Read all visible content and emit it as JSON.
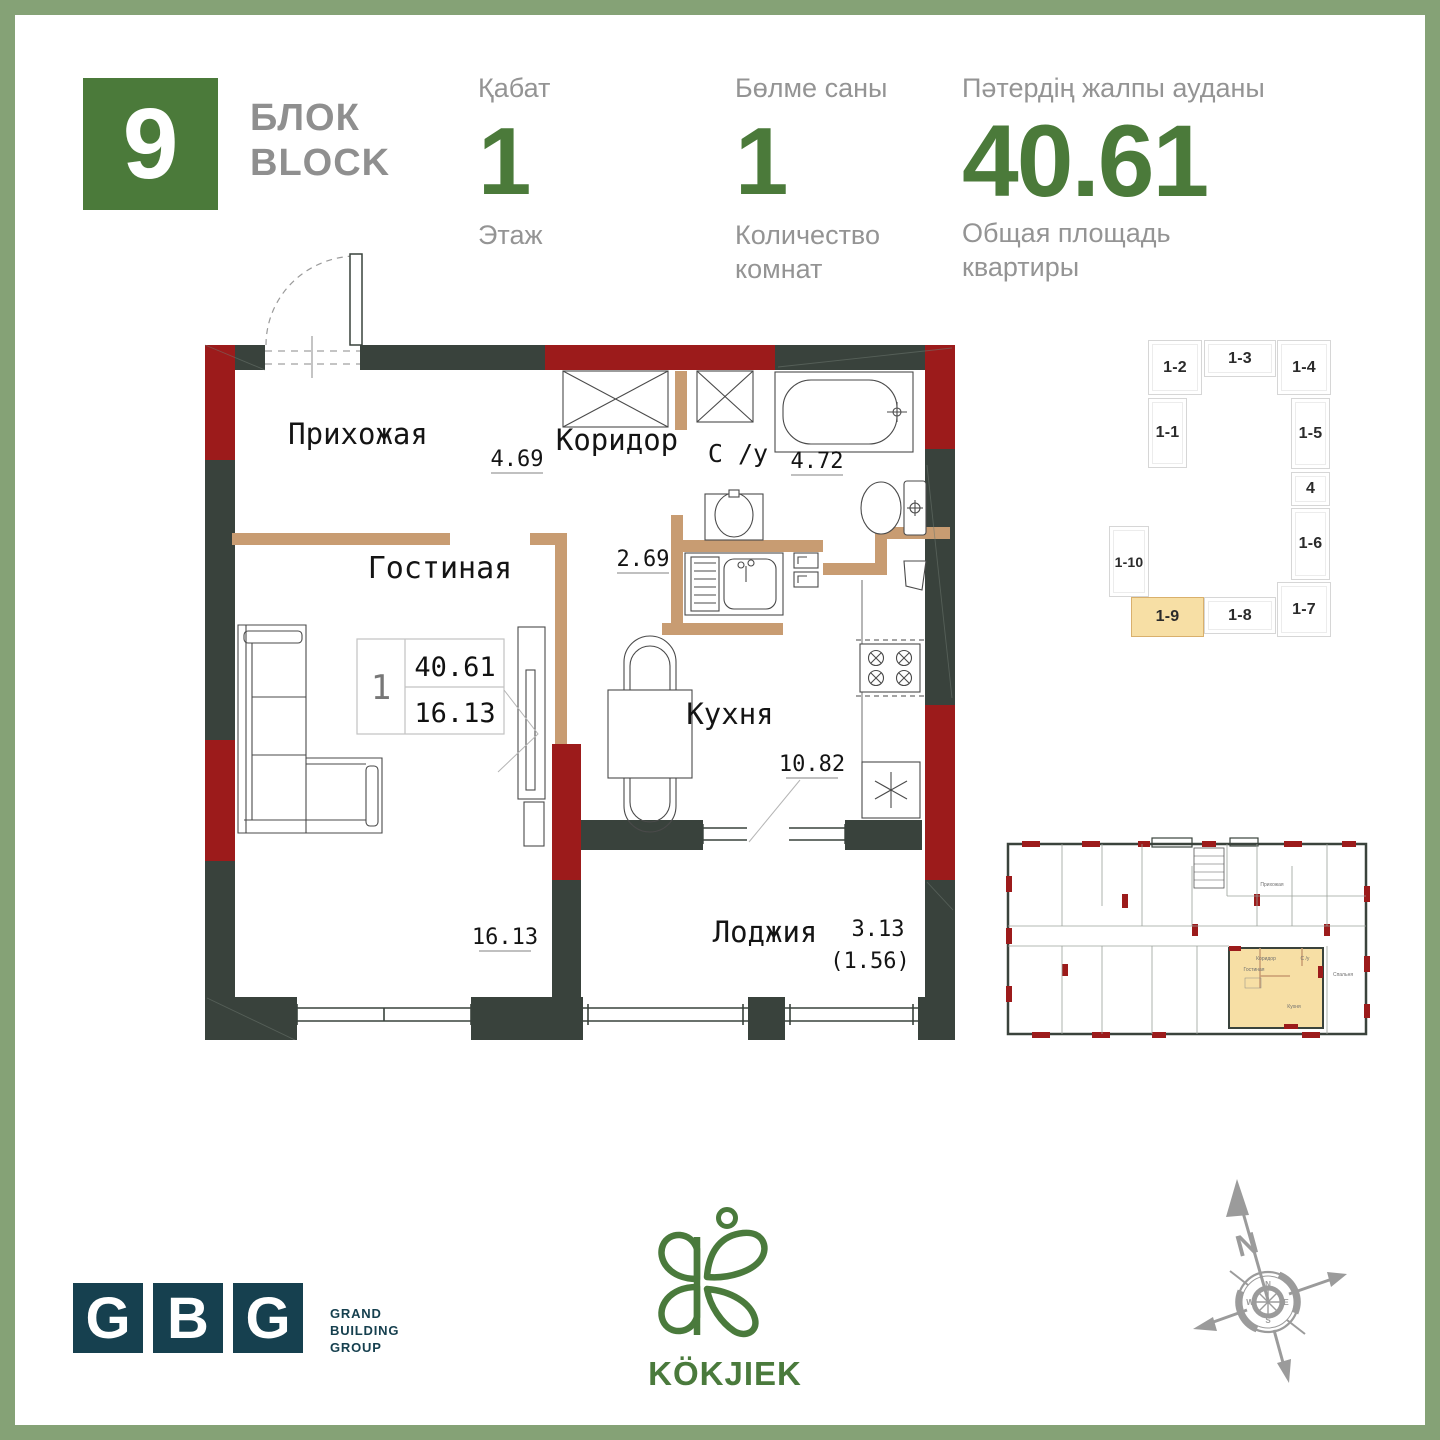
{
  "header": {
    "block_number": "9",
    "block_label_line1": "БЛОК",
    "block_label_line2": "BLOCK",
    "floor": {
      "label_kz": "Қабат",
      "value": "1",
      "label_ru": "Этаж"
    },
    "rooms": {
      "label_kz": "Бөлме саны",
      "value": "1",
      "label_ru": "Количество комнат"
    },
    "area": {
      "label_kz": "Пәтердің жалпы ауданы",
      "value": "40.61",
      "label_ru": "Общая площадь квартиры"
    }
  },
  "plan": {
    "entry_label": "Прихожая",
    "corridor_label": "Коридор",
    "corridor_area": "4.69",
    "bathroom_label": "С /у",
    "bathroom_area": "4.72",
    "kitchen_dim": "2.69",
    "living_label": "Гостиная",
    "living_area": "16.13",
    "kitchen_label": "Кухня",
    "kitchen_area": "10.82",
    "loggia_label": "Лоджия",
    "loggia_area": "3.13",
    "loggia_area_coef": "(1.56)",
    "info_box": {
      "rooms": "1",
      "total_area": "40.61",
      "living_area": "16.13"
    }
  },
  "unit_map": {
    "highlighted": "1-9",
    "units": [
      {
        "label": "1-2"
      },
      {
        "label": "1-3"
      },
      {
        "label": "1-4"
      },
      {
        "label": "1-1"
      },
      {
        "label": "1-5"
      },
      {
        "label": "4"
      },
      {
        "label": "1-6"
      },
      {
        "label": "1-10"
      },
      {
        "label": "1-9"
      },
      {
        "label": "1-8"
      },
      {
        "label": "1-7"
      }
    ]
  },
  "mini_plan": {
    "labels": [
      "Гостиная",
      "Кухня",
      "Коридор",
      "С /у",
      "Прихожая",
      "Спальня"
    ]
  },
  "footer": {
    "gbg": {
      "letter1": "G",
      "letter2": "B",
      "letter3": "G",
      "line1": "GRAND",
      "line2": "BUILDING",
      "line3": "GROUP"
    },
    "brand": {
      "name": "KÖKJIEK"
    },
    "compass": {
      "north": "N",
      "ring_n": "N",
      "ring_e": "E",
      "ring_s": "S",
      "ring_w": "W"
    }
  },
  "colors": {
    "frame_green": "#85a276",
    "accent_green": "#4b7a3a",
    "wall_dark": "#39423c",
    "wall_red": "#9c1b1b",
    "wall_tan": "#c89c72",
    "highlight_tan": "#f7dfa5",
    "gbg_navy": "#16404f",
    "brand_green": "#4a7a3c",
    "gray_text": "#949494"
  }
}
